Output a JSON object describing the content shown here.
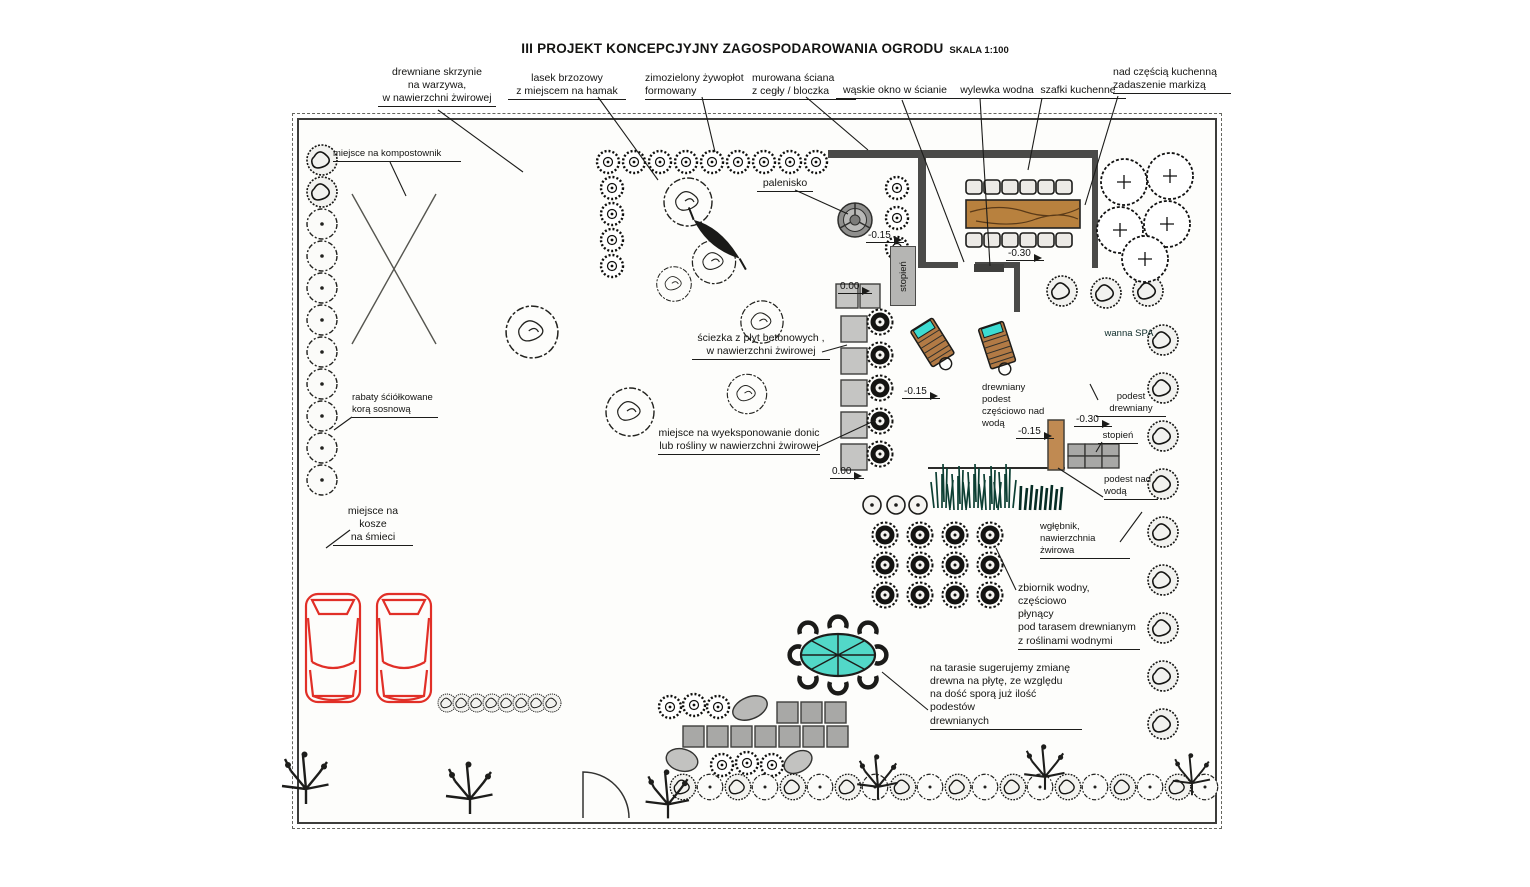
{
  "title": {
    "main": "III PROJEKT KONCEPCJYJNY ZAGOSPODAROWANIA OGRODU",
    "scale": "SKALA 1:100"
  },
  "labels": {
    "veg_boxes": "drewniane skrzynie\nna warzywa,\nw nawierzchni żwirowej",
    "birch_grove": "lasek brzozowy\nz miejscem na hamak",
    "hedge": "zimozielony żywopłot\nformowany",
    "wall": "murowana ściana\nz cegły / bloczka",
    "window": "wąskie okno w ścianie",
    "water_spout": "wylewka wodna",
    "kitchen_cabinets": "szafki kuchenne",
    "awning": "nad częścią kuchenną\nzadaszenie markizą",
    "composter": "miejsce na kompostownik",
    "fire_pit": "palenisko",
    "path": "ściezka z płyt betonowych ,\nw nawierzchni żwirowej",
    "mulch_beds": "rabaty śćiółkowane\nkorą sosnową",
    "pots_display": "miejsce na wyeksponowanie donic\nlub rośliny w nawierzchni żwirowej",
    "trash": "miejsce na kosze\nna śmieci",
    "spa": "wanna SPA",
    "deck_over_water": "drewniany podest\nczęściowo nad\nwodą",
    "wood_deck": "podest drewniany",
    "step": "stopień",
    "deck_above_water": "podest nad\nwodą",
    "sunken_gravel": "wgłębnik, nawierzchnia\nżwirowa",
    "water_tank": "zbiornik wodny, częściowo\npłynący\npod tarasem drewnianym\nz roślinami wodnymi",
    "terrace_note": "na tarasie sugerujemy zmianę\ndrewna na płytę, ze względu\nna dość sporą już ilość podestów\ndrewnianych"
  },
  "elevations": {
    "minus015_top": "-0.15",
    "stopien_vertical": "stopień",
    "zero_mid": "0.00",
    "minus030_top": "-0.30",
    "minus015_deck": "-0.15",
    "minus030_spa": "-0.30",
    "minus015_spa": "-0.15",
    "zero_low": "0.00"
  },
  "colors": {
    "lawn": "#93ae44",
    "water": "#4fe3d4",
    "deck_wood": "#c08a52",
    "car_outline": "#e12f27"
  }
}
